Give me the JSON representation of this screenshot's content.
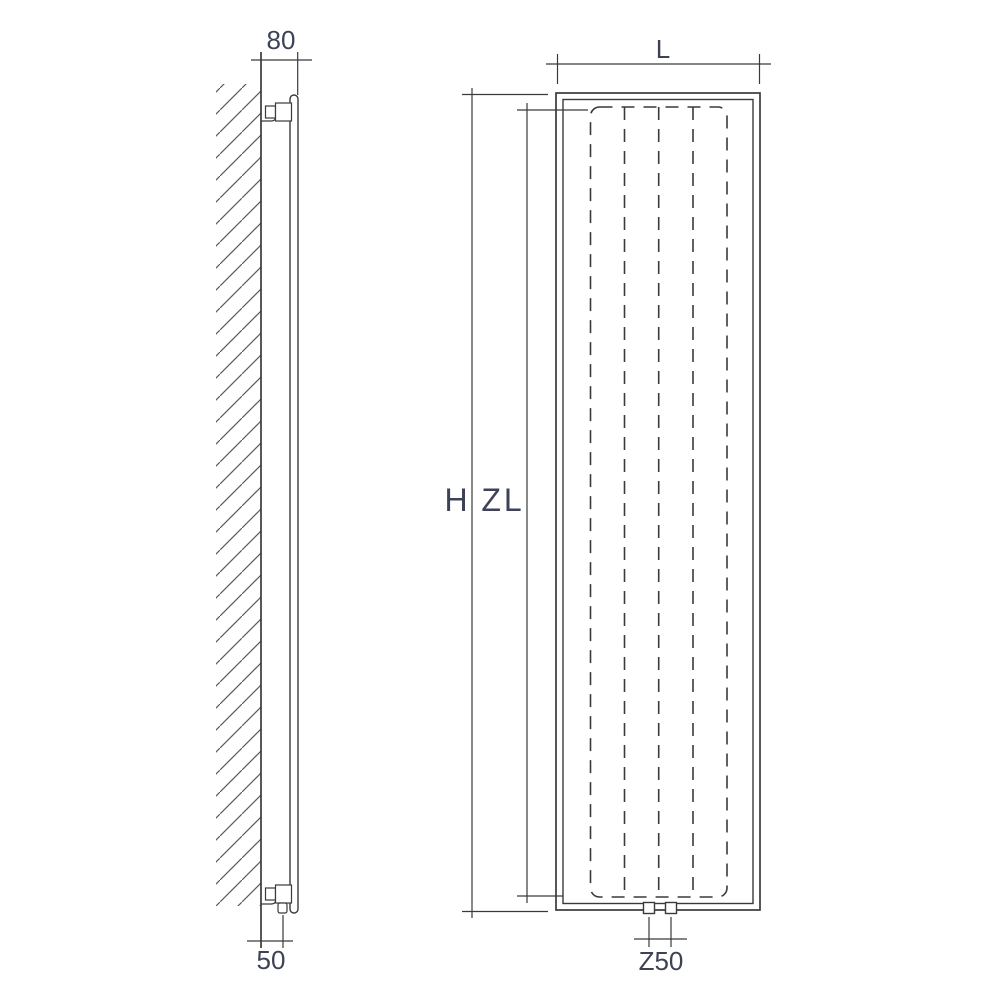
{
  "colors": {
    "background": "#ffffff",
    "line": "#3a3a3a",
    "hatch": "#5a5a5a",
    "text": "#3e4257"
  },
  "side_view": {
    "top_dimension_label": "80",
    "bottom_dimension_label": "50"
  },
  "front_view": {
    "width_dimension_label": "L",
    "overall_height_label": "H",
    "element_height_label": "ZL",
    "connection_spacing_label": "Z50"
  }
}
